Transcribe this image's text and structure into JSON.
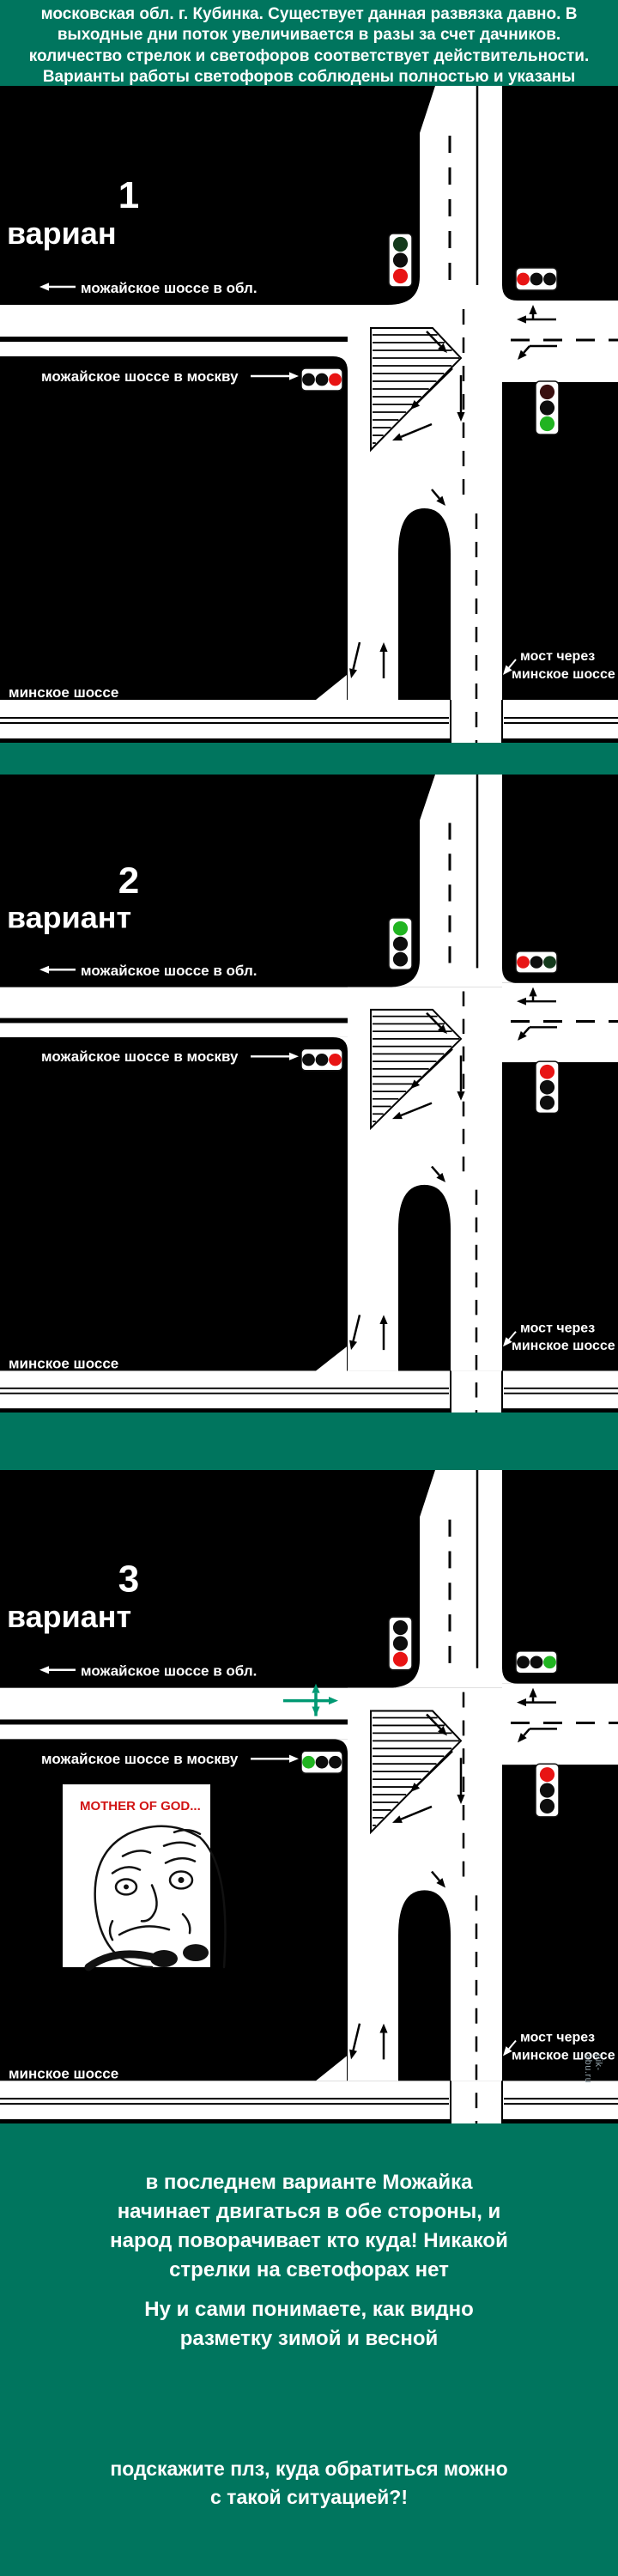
{
  "colors": {
    "page_green": "#00755e",
    "diagram_black": "#000000",
    "road_white": "#ffffff",
    "meme_caption_red": "#d11414",
    "two_way_arrow_green": "#009973",
    "watermark_gray": "#90a0a8"
  },
  "signal_colors": {
    "red": "#e81414",
    "green": "#21b421",
    "off": "#0d0d0d",
    "dim_green": "#143a1c",
    "dim_red": "#3a0f0f"
  },
  "header": {
    "text": "московская обл. г. Кубинка. Существует данная развязка давно. В выходные дни поток увеличивается в разы за счет дачников. количество стрелок и светофоров соответствует действительности. Варианты работы светофоров соблюдены полностью и указаны ниже"
  },
  "labels": {
    "to_region": "можайское шоссе в обл.",
    "to_moscow": "можайское шоссе в москву",
    "minsk": "минское шоссе",
    "bridge_caption_line1": "мост через",
    "bridge_caption_line2": "минское шоссе"
  },
  "variants": [
    {
      "number": "1",
      "title": "вариан",
      "signals": {
        "bridge": [
          "dim_green",
          "off",
          "red"
        ],
        "top_right": [
          "red",
          "off",
          "off"
        ],
        "to_moscow": [
          "off",
          "off",
          "red"
        ],
        "right_side": [
          "dim_red",
          "off",
          "green"
        ]
      },
      "two_way_arrows": false,
      "meme": false
    },
    {
      "number": "2",
      "title": "вариант",
      "signals": {
        "bridge": [
          "green",
          "off",
          "off"
        ],
        "top_right": [
          "red",
          "off",
          "dim_green"
        ],
        "to_moscow": [
          "off",
          "off",
          "red"
        ],
        "right_side": [
          "red",
          "off",
          "off"
        ]
      },
      "two_way_arrows": false,
      "meme": false
    },
    {
      "number": "3",
      "title": "вариант",
      "signals": {
        "bridge": [
          "off",
          "off",
          "red"
        ],
        "top_right": [
          "off",
          "off",
          "green"
        ],
        "to_moscow": [
          "green",
          "off",
          "off"
        ],
        "right_side": [
          "red",
          "off",
          "off"
        ]
      },
      "two_way_arrows": true,
      "meme": true
    }
  ],
  "meme": {
    "caption": "MOTHER OF GOD..."
  },
  "footer": {
    "para1_lines": [
      "в последнем варианте Можайка",
      "начинает двигаться в обе стороны, и",
      "народ поворачивает кто куда! Никакой",
      "стрелки на светофорах нет"
    ],
    "para2_lines": [
      "Ну и сами понимаете, как видно",
      "разметку зимой и весной"
    ],
    "para3_lines": [
      "подскажите плз, куда обратиться можно",
      "с такой ситуацией?!"
    ]
  },
  "watermark": "pik-abu.ru"
}
